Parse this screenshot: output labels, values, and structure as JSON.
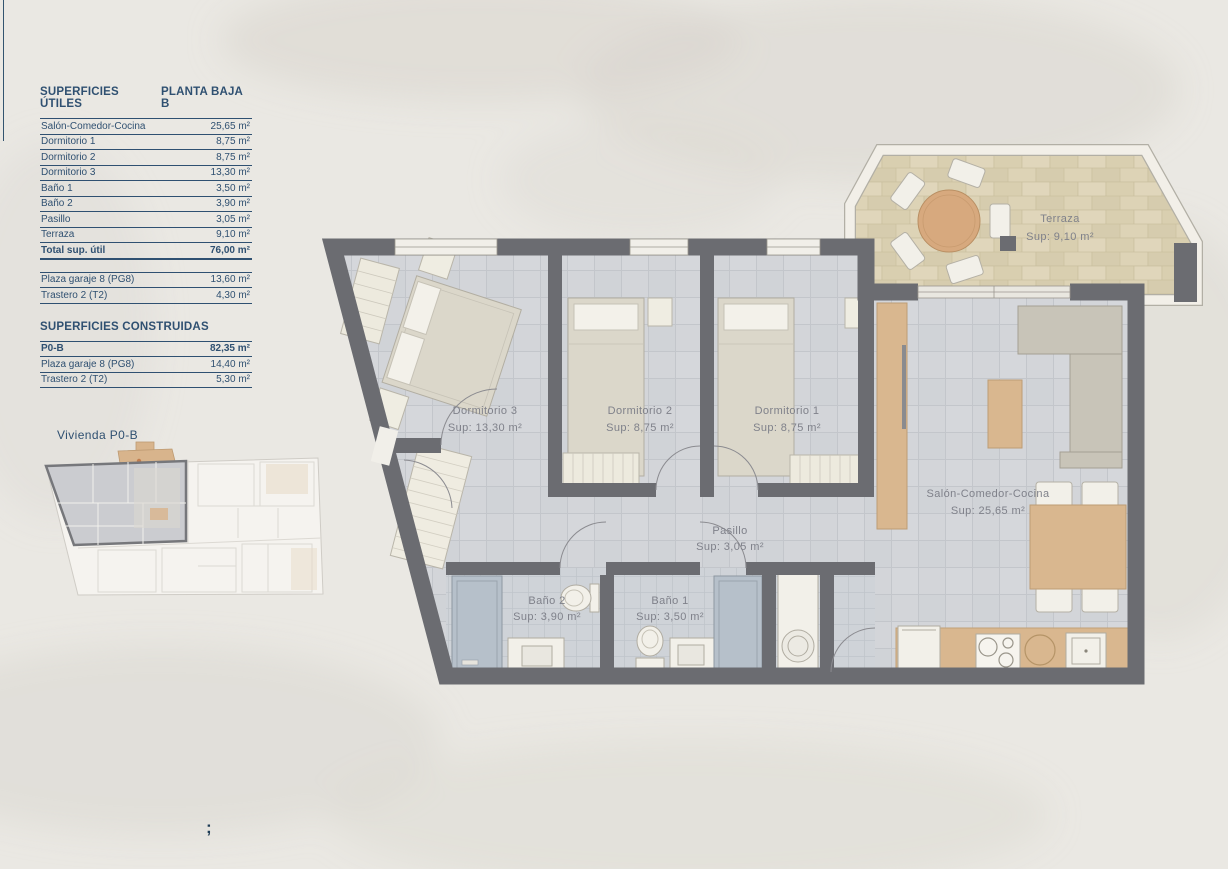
{
  "palette": {
    "accent": "#2f5071",
    "wall": "#6b6c71",
    "tile": "#d3d5d9",
    "terrace_stone": "#dbd1b4",
    "wood": "#d9b78f",
    "label": "#7f818a"
  },
  "tables": {
    "utiles": {
      "title": "SUPERFICIES ÚTILES",
      "subtitle": "PLANTA BAJA B",
      "rows": [
        {
          "label": "Salón-Comedor-Cocina",
          "value": "25,65 m²"
        },
        {
          "label": "Dormitorio 1",
          "value": "8,75 m²"
        },
        {
          "label": "Dormitorio 2",
          "value": "8,75 m²"
        },
        {
          "label": "Dormitorio 3",
          "value": "13,30 m²"
        },
        {
          "label": "Baño 1",
          "value": "3,50 m²"
        },
        {
          "label": "Baño 2",
          "value": "3,90 m²"
        },
        {
          "label": "Pasillo",
          "value": "3,05 m²"
        },
        {
          "label": "Terraza",
          "value": "9,10 m²"
        }
      ],
      "total": {
        "label": "Total sup. útil",
        "value": "76,00 m²"
      },
      "extra_rows": [
        {
          "label": "Plaza garaje 8 (PG8)",
          "value": "13,60 m²"
        },
        {
          "label": "Trastero 2 (T2)",
          "value": "4,30 m²"
        }
      ]
    },
    "construidas": {
      "title": "SUPERFICIES CONSTRUIDAS",
      "rows": [
        {
          "label": "P0-B",
          "value": "82,35 m²"
        },
        {
          "label": "Plaza garaje 8 (PG8)",
          "value": "14,40 m²"
        },
        {
          "label": "Trastero 2 (T2)",
          "value": "5,30 m²"
        }
      ]
    }
  },
  "mini_plan": {
    "title": "Vivienda P0-B"
  },
  "floor_plan": {
    "rooms": [
      {
        "name": "Terraza",
        "sup": "Sup: 9,10 m²"
      },
      {
        "name": "Dormitorio 3",
        "sup": "Sup: 13,30 m²"
      },
      {
        "name": "Dormitorio 2",
        "sup": "Sup: 8,75 m²"
      },
      {
        "name": "Dormitorio 1",
        "sup": "Sup: 8,75 m²"
      },
      {
        "name": "Salón-Comedor-Cocina",
        "sup": "Sup: 25,65 m²"
      },
      {
        "name": "Pasillo",
        "sup": "Sup: 3,05 m²"
      },
      {
        "name": "Baño 2",
        "sup": "Sup: 3,90 m²"
      },
      {
        "name": "Baño 1",
        "sup": "Sup: 3,50 m²"
      }
    ]
  },
  "footer": {
    "mark": ";"
  }
}
